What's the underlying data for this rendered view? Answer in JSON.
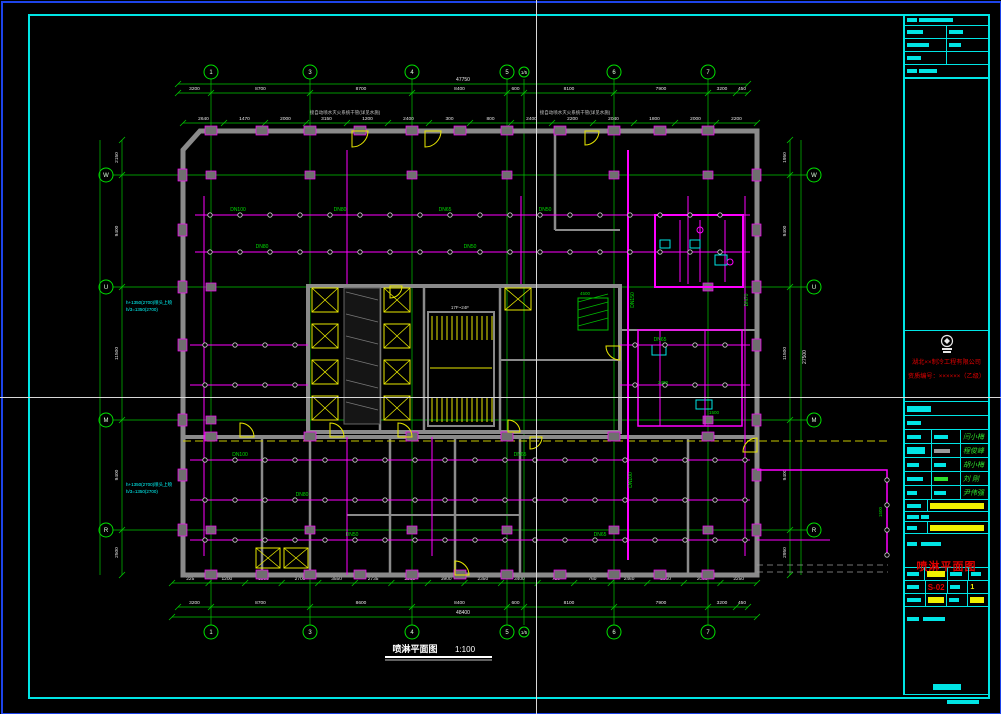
{
  "app": {
    "canvas_color": "#000000",
    "window_border_color": "#1d43e8",
    "crosshair": {
      "x": 536,
      "y": 397,
      "color": "#d8d8d8"
    }
  },
  "footer": {
    "title": "喷淋平面图",
    "scale": "1:100"
  },
  "title_block": {
    "company_line1": "湖北××制冷工程有限公司",
    "company_line2": "资质编号：××××××（乙级）",
    "signatures": {
      "names": [
        "闫小梅",
        "程俊峰",
        "胡小梅",
        "刘 刚",
        "尹伟强"
      ]
    },
    "drawing_title": "喷淋平面图",
    "drawing_no": "S-02",
    "sheet_no": "1"
  },
  "plan": {
    "grid": {
      "cols": [
        {
          "label": "1",
          "x": 211
        },
        {
          "label": "3",
          "x": 310
        },
        {
          "label": "4",
          "x": 412
        },
        {
          "label": "5",
          "x": 507
        },
        {
          "label": "1/5",
          "x": 524,
          "small": true
        },
        {
          "label": "6",
          "x": 614
        },
        {
          "label": "7",
          "x": 708
        }
      ],
      "rows": [
        {
          "label": "W",
          "y": 175
        },
        {
          "label": "U",
          "y": 287
        },
        {
          "label": "M",
          "y": 420
        },
        {
          "label": "R",
          "y": 530
        }
      ]
    },
    "dims": {
      "top_overall": "47750",
      "top_chain": {
        "ticks": [
          178,
          211,
          310,
          412,
          507,
          524,
          614,
          708,
          736,
          748
        ],
        "values": [
          "3200",
          "8700",
          "8700",
          "8400",
          "600",
          "8100",
          "7900",
          "3200",
          "450"
        ]
      },
      "top_detail": [
        "2640",
        "1470",
        "2000",
        "3150",
        "1200",
        "2400",
        "300",
        "800",
        "2400",
        "2200",
        "2040",
        "1800",
        "2000",
        "2200"
      ],
      "bottom_detail": [
        "225",
        "1200",
        "1900",
        "2700",
        "3550",
        "2735",
        "2563",
        "3900",
        "2350",
        "3400",
        "750",
        "760",
        "2460",
        "2350",
        "2080",
        "2250"
      ],
      "bottom_chain": {
        "ticks": [
          178,
          211,
          310,
          412,
          507,
          524,
          614,
          708,
          736,
          748
        ],
        "values": [
          "3200",
          "8700",
          "8600",
          "8400",
          "600",
          "8100",
          "7900",
          "3200",
          "450"
        ]
      },
      "bottom_overall": "48400",
      "left_chain": {
        "ticks": [
          140,
          175,
          287,
          420,
          530,
          575
        ],
        "values": [
          "2150",
          "9400",
          "11500",
          "9400",
          "2500"
        ]
      },
      "right_chain": {
        "ticks": [
          140,
          175,
          287,
          420,
          530,
          575
        ],
        "values": [
          "1950",
          "9400",
          "11500",
          "9400",
          "2950"
        ]
      },
      "right_overall": "27500"
    },
    "annotations": [
      {
        "x": 345,
        "y": 114,
        "t": "接自动喷水灭火系统干管(详见水施)",
        "c": "#c8c8c8",
        "s": 4.5
      },
      {
        "x": 575,
        "y": 114,
        "t": "接自动喷水灭火系统干管(详见水施)",
        "c": "#c8c8c8",
        "s": 4.5
      },
      {
        "x": 126,
        "y": 304,
        "t": "h+1350(2700)喷头上喷",
        "c": "#00ffff",
        "s": 4.5,
        "a": "start"
      },
      {
        "x": 126,
        "y": 311,
        "t": "h/3=1350(2700)",
        "c": "#00ffff",
        "s": 4.5,
        "a": "start"
      },
      {
        "x": 126,
        "y": 486,
        "t": "h+1350(2700)喷头上喷",
        "c": "#00ffff",
        "s": 4.5,
        "a": "start"
      },
      {
        "x": 126,
        "y": 493,
        "t": "h/3=1350(2700)",
        "c": "#00ffff",
        "s": 4.5,
        "a": "start"
      },
      {
        "x": 460,
        "y": 309,
        "t": "17F~24F",
        "c": "#dddddd",
        "s": 4.5
      },
      {
        "x": 585,
        "y": 295,
        "t": "4500",
        "c": "#00dd00",
        "s": 4.5
      },
      {
        "x": 663,
        "y": 384,
        "t": "2400",
        "c": "#00dd00",
        "s": 4.5
      },
      {
        "x": 714,
        "y": 414,
        "t": "1500",
        "c": "#00dd00",
        "s": 4.5
      },
      {
        "x": 882,
        "y": 512,
        "t": "1500",
        "c": "#00dd00",
        "s": 4.5,
        "r": -90
      }
    ],
    "pipe_labels": [
      {
        "x": 238,
        "y": 211,
        "t": "DN100"
      },
      {
        "x": 340,
        "y": 211,
        "t": "DN80"
      },
      {
        "x": 445,
        "y": 211,
        "t": "DN65"
      },
      {
        "x": 545,
        "y": 211,
        "t": "DN50"
      },
      {
        "x": 262,
        "y": 248,
        "t": "DN80"
      },
      {
        "x": 470,
        "y": 248,
        "t": "DN50"
      },
      {
        "x": 660,
        "y": 341,
        "t": "DN65"
      },
      {
        "x": 240,
        "y": 456,
        "t": "DN100"
      },
      {
        "x": 520,
        "y": 456,
        "t": "DN65"
      },
      {
        "x": 302,
        "y": 496,
        "t": "DN80"
      },
      {
        "x": 352,
        "y": 536,
        "t": "DN50"
      },
      {
        "x": 600,
        "y": 536,
        "t": "DN65"
      },
      {
        "x": 634,
        "y": 300,
        "t": "DN150",
        "r": -90
      },
      {
        "x": 632,
        "y": 480,
        "t": "DN100",
        "r": -90
      },
      {
        "x": 748,
        "y": 300,
        "t": "DN70",
        "r": -90
      }
    ]
  }
}
